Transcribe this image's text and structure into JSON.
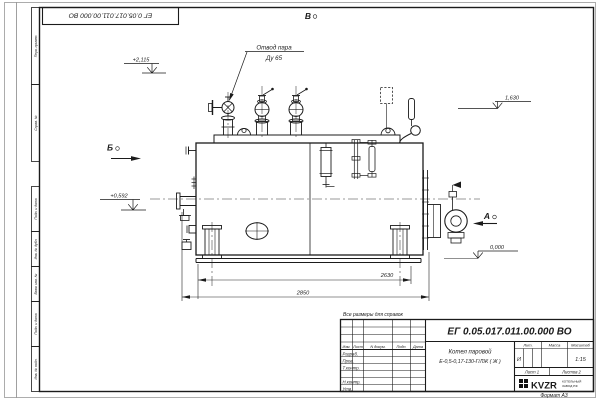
{
  "sheet": {
    "doc_number": "ЕГ 0.05.017.011.00.000  ВО",
    "format_label": "Формат А3",
    "note_reference": "Все размеры для справок"
  },
  "margin_columns": {
    "perv_primen": "Перв. примен.",
    "sprav_no": "Справ. №",
    "podp_data_1": "Подп. и дата",
    "inv_dubl": "Инв. № дубл.",
    "vzam_inv": "Взам. инв. №",
    "podp_data_2": "Подп. и дата",
    "inv_podl": "Инв. № подл."
  },
  "annotations": {
    "steam_outlet_line1": "Отвод пара",
    "steam_outlet_line2": "Ду 65",
    "elevation_valves": "+2,115",
    "elevation_left_pipe": "+0,592",
    "elevation_right": "1,630",
    "elevation_zero": "0,000",
    "dim_inner": "2630",
    "dim_overall": "2850",
    "view_a_label": "А",
    "view_b_label": "Б",
    "view_v_label": "В"
  },
  "title_block": {
    "doc_number": "ЕГ 0.05.017.011.00.000  ВО",
    "product_name": "Котел паровой",
    "product_model": "Е-0,5-0,17-130-Г/ЛЖ ( Ж )",
    "headers": {
      "izm": "Изм.",
      "list": "Лист",
      "n_dokum": "N докум.",
      "podp": "Подп.",
      "data": "Дата",
      "lit": "Лит.",
      "massa": "Масса",
      "masshtab": "Масштаб"
    },
    "rows": {
      "razrab": "Разраб.",
      "prov": "Пров.",
      "t_kontr": "Т.контр.",
      "n_kontr": "Н.контр.",
      "utv": "Утв."
    },
    "lit_value": "И",
    "scale_value": "1:15",
    "sheet_label_value": "Лист 1",
    "sheets_label_value": "Листов 2",
    "logo": {
      "brand": "KVZR",
      "sub_line1": "КОТЕЛЬНЫЙ",
      "sub_line2": "ЗАВОД РФ"
    }
  }
}
